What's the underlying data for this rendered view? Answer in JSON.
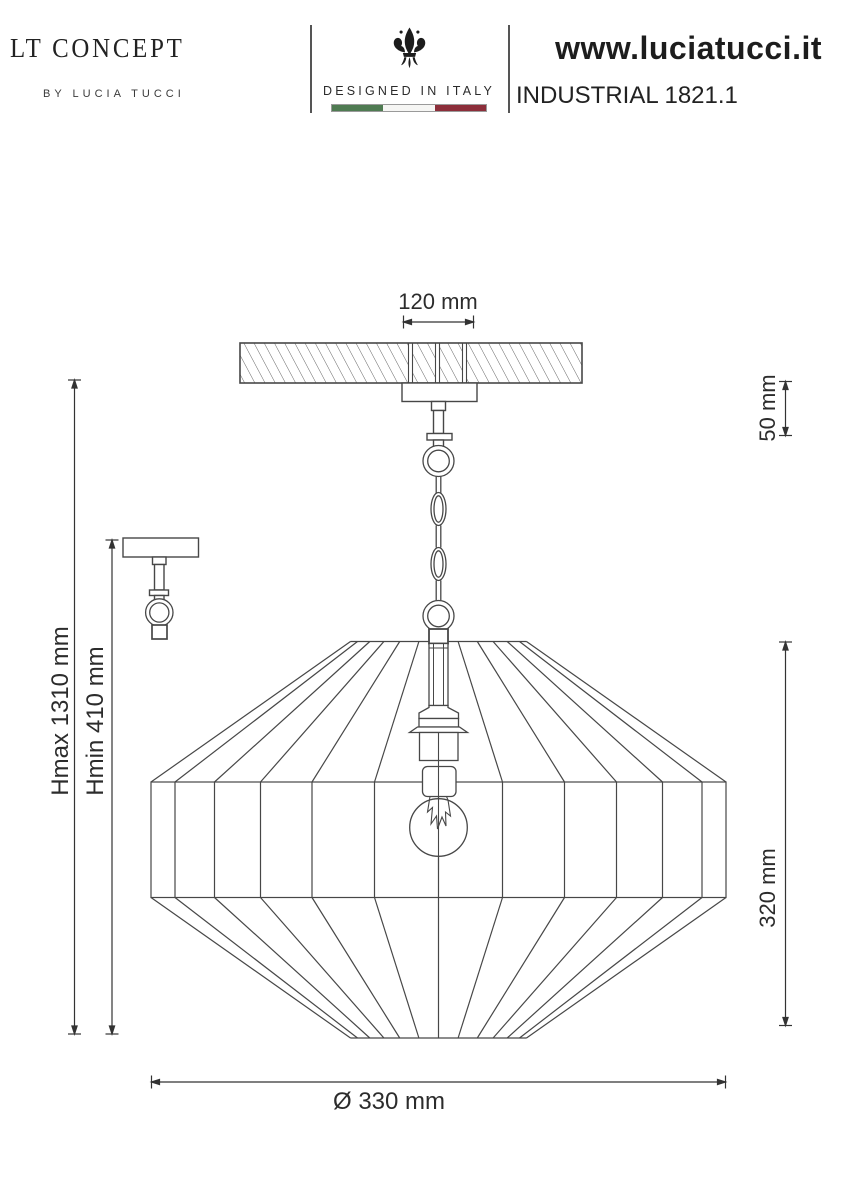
{
  "header": {
    "brand": {
      "name": "LT CONCEPT",
      "byline": "BY LUCIA TUCCI"
    },
    "made_in": {
      "icon": "fleur-de-lis-icon",
      "tagline": "DESIGNED IN ITALY",
      "flag_colors": {
        "green": "#4f7b52",
        "white": "#f6f6f4",
        "red": "#8c2e3a"
      }
    },
    "product": {
      "website": "www.luciatucci.it",
      "model": "INDUSTRIAL 1821.1"
    }
  },
  "drawing": {
    "subject": "pendant lamp technical drawing",
    "line_color": "#474747",
    "dimensions": {
      "canopy_width": "120 mm",
      "ceiling_offset": "50 mm",
      "height_max": "Hmax 1310 mm",
      "height_min": "Hmin 410 mm",
      "shade_height": "320 mm",
      "shade_diameter": "Ø 330 mm"
    }
  }
}
